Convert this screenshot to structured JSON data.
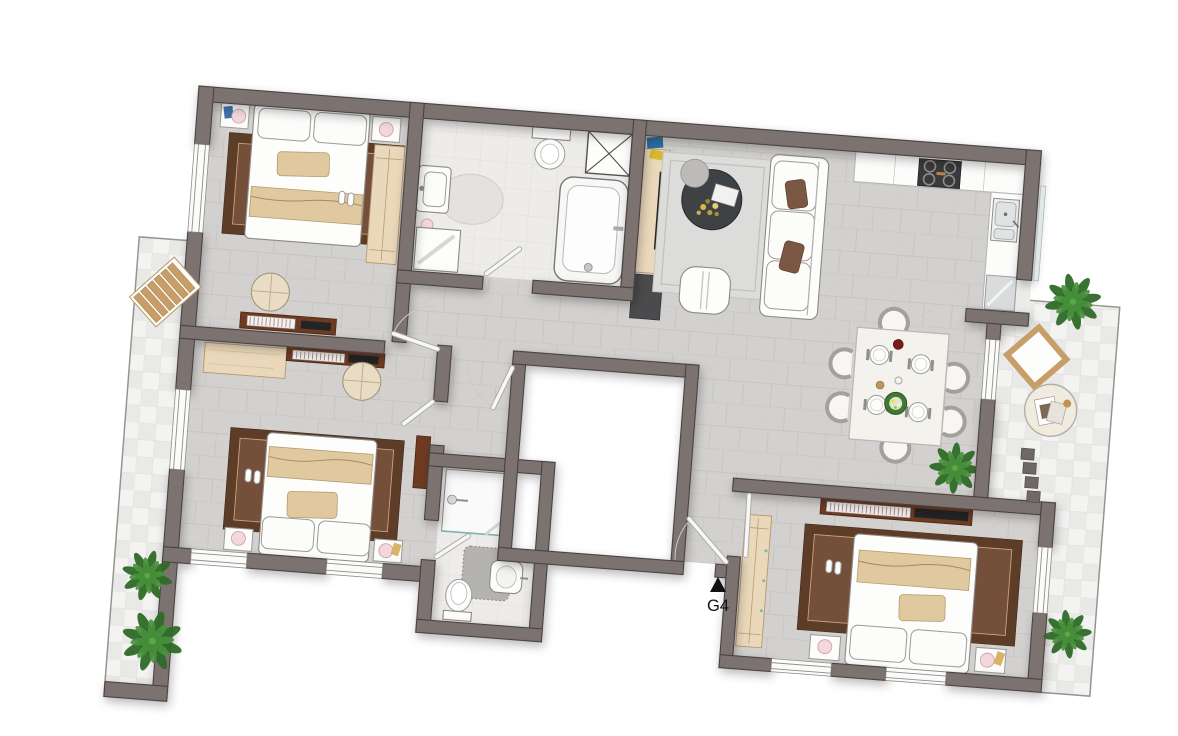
{
  "plan": {
    "unit_label": "G4",
    "entrance_marker": "triangle-up",
    "rotation_deg": 4.4,
    "colors": {
      "wall": "#7c7270",
      "wall_outline": "#474140",
      "floor_tile": "#d2d1cf",
      "floor_vein": "#c6c5c2",
      "bath_floor": "#edecea",
      "balcony_floor": "#f3f3f2",
      "void_fill": "#ffffff",
      "rug_brown_dark": "#5d3d28",
      "rug_brown_light": "#74503a",
      "living_rug": "#dcdcda",
      "wood_light": "#ead8ba",
      "console_brown": "#6e3b22",
      "sofa_pillow_brown": "#7a5743",
      "coffee_table": "#3e4245",
      "plant_green": "#2f6b28",
      "plant_green_light": "#49923c",
      "plant_pot": "#1a150f",
      "lamp_pink": "#f3d7da",
      "appliance_dark": "#3a3a3a",
      "marker_black": "#111111"
    },
    "rooms": [
      "bedroom-1",
      "bathroom",
      "hallway",
      "living-room",
      "kitchen",
      "dining-area",
      "bedroom-2",
      "ensuite-bathroom",
      "bedroom-3",
      "stairwell-void",
      "entrance",
      "balcony-left",
      "balcony-right",
      "balcony-bedroom-3"
    ],
    "furniture_icons": [
      "double-bed",
      "nightstand",
      "table-lamp",
      "wardrobe",
      "rug",
      "desk",
      "media-console",
      "tv",
      "pouf",
      "sofa",
      "coffee-table",
      "dining-table",
      "dining-chair",
      "plate",
      "salad-bowl",
      "kitchen-counter",
      "stove",
      "kitchen-sink",
      "fridge",
      "bathtub",
      "toilet",
      "washbasin",
      "washing-machine",
      "shower",
      "bath-rug",
      "potted-plant",
      "sun-lounger",
      "outdoor-chair",
      "outdoor-table",
      "step-stones",
      "door",
      "window",
      "ventilation-shaft"
    ]
  }
}
